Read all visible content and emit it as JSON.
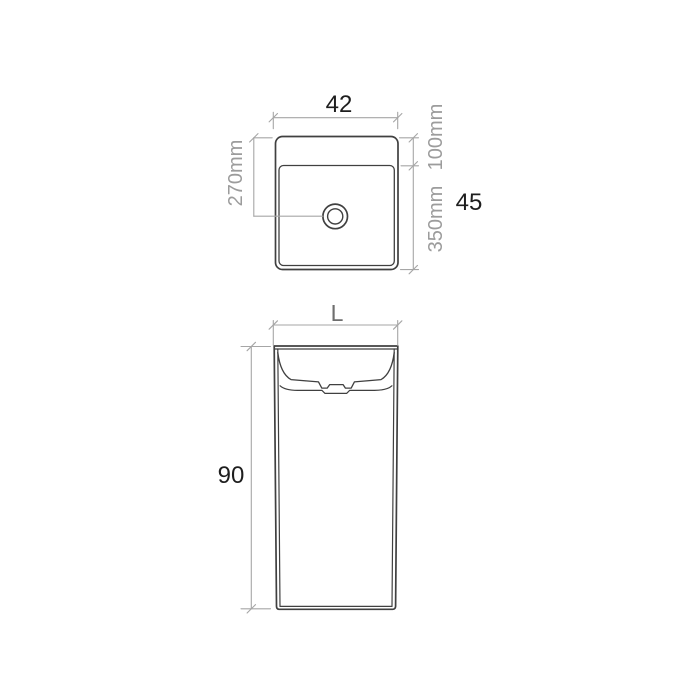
{
  "page": {
    "title": "Freestanding basin technical drawing",
    "background": "#ffffff"
  },
  "colors": {
    "outline": "#404040",
    "dimension_line": "#a6a6a6",
    "dimension_text_grey": "#9c9c9c",
    "dimension_text_black": "#1e1e1e",
    "width_letter_grey": "#6e6e6e"
  },
  "top_view": {
    "name": "basin plan (top) view",
    "width_label": "42",
    "height_label": "45",
    "left_dim_label": "270mm",
    "right_dim_upper_label": "100mm",
    "right_dim_lower_label": "350mm"
  },
  "front_view": {
    "name": "pedestal front view",
    "width_label": "L",
    "height_label": "90"
  }
}
